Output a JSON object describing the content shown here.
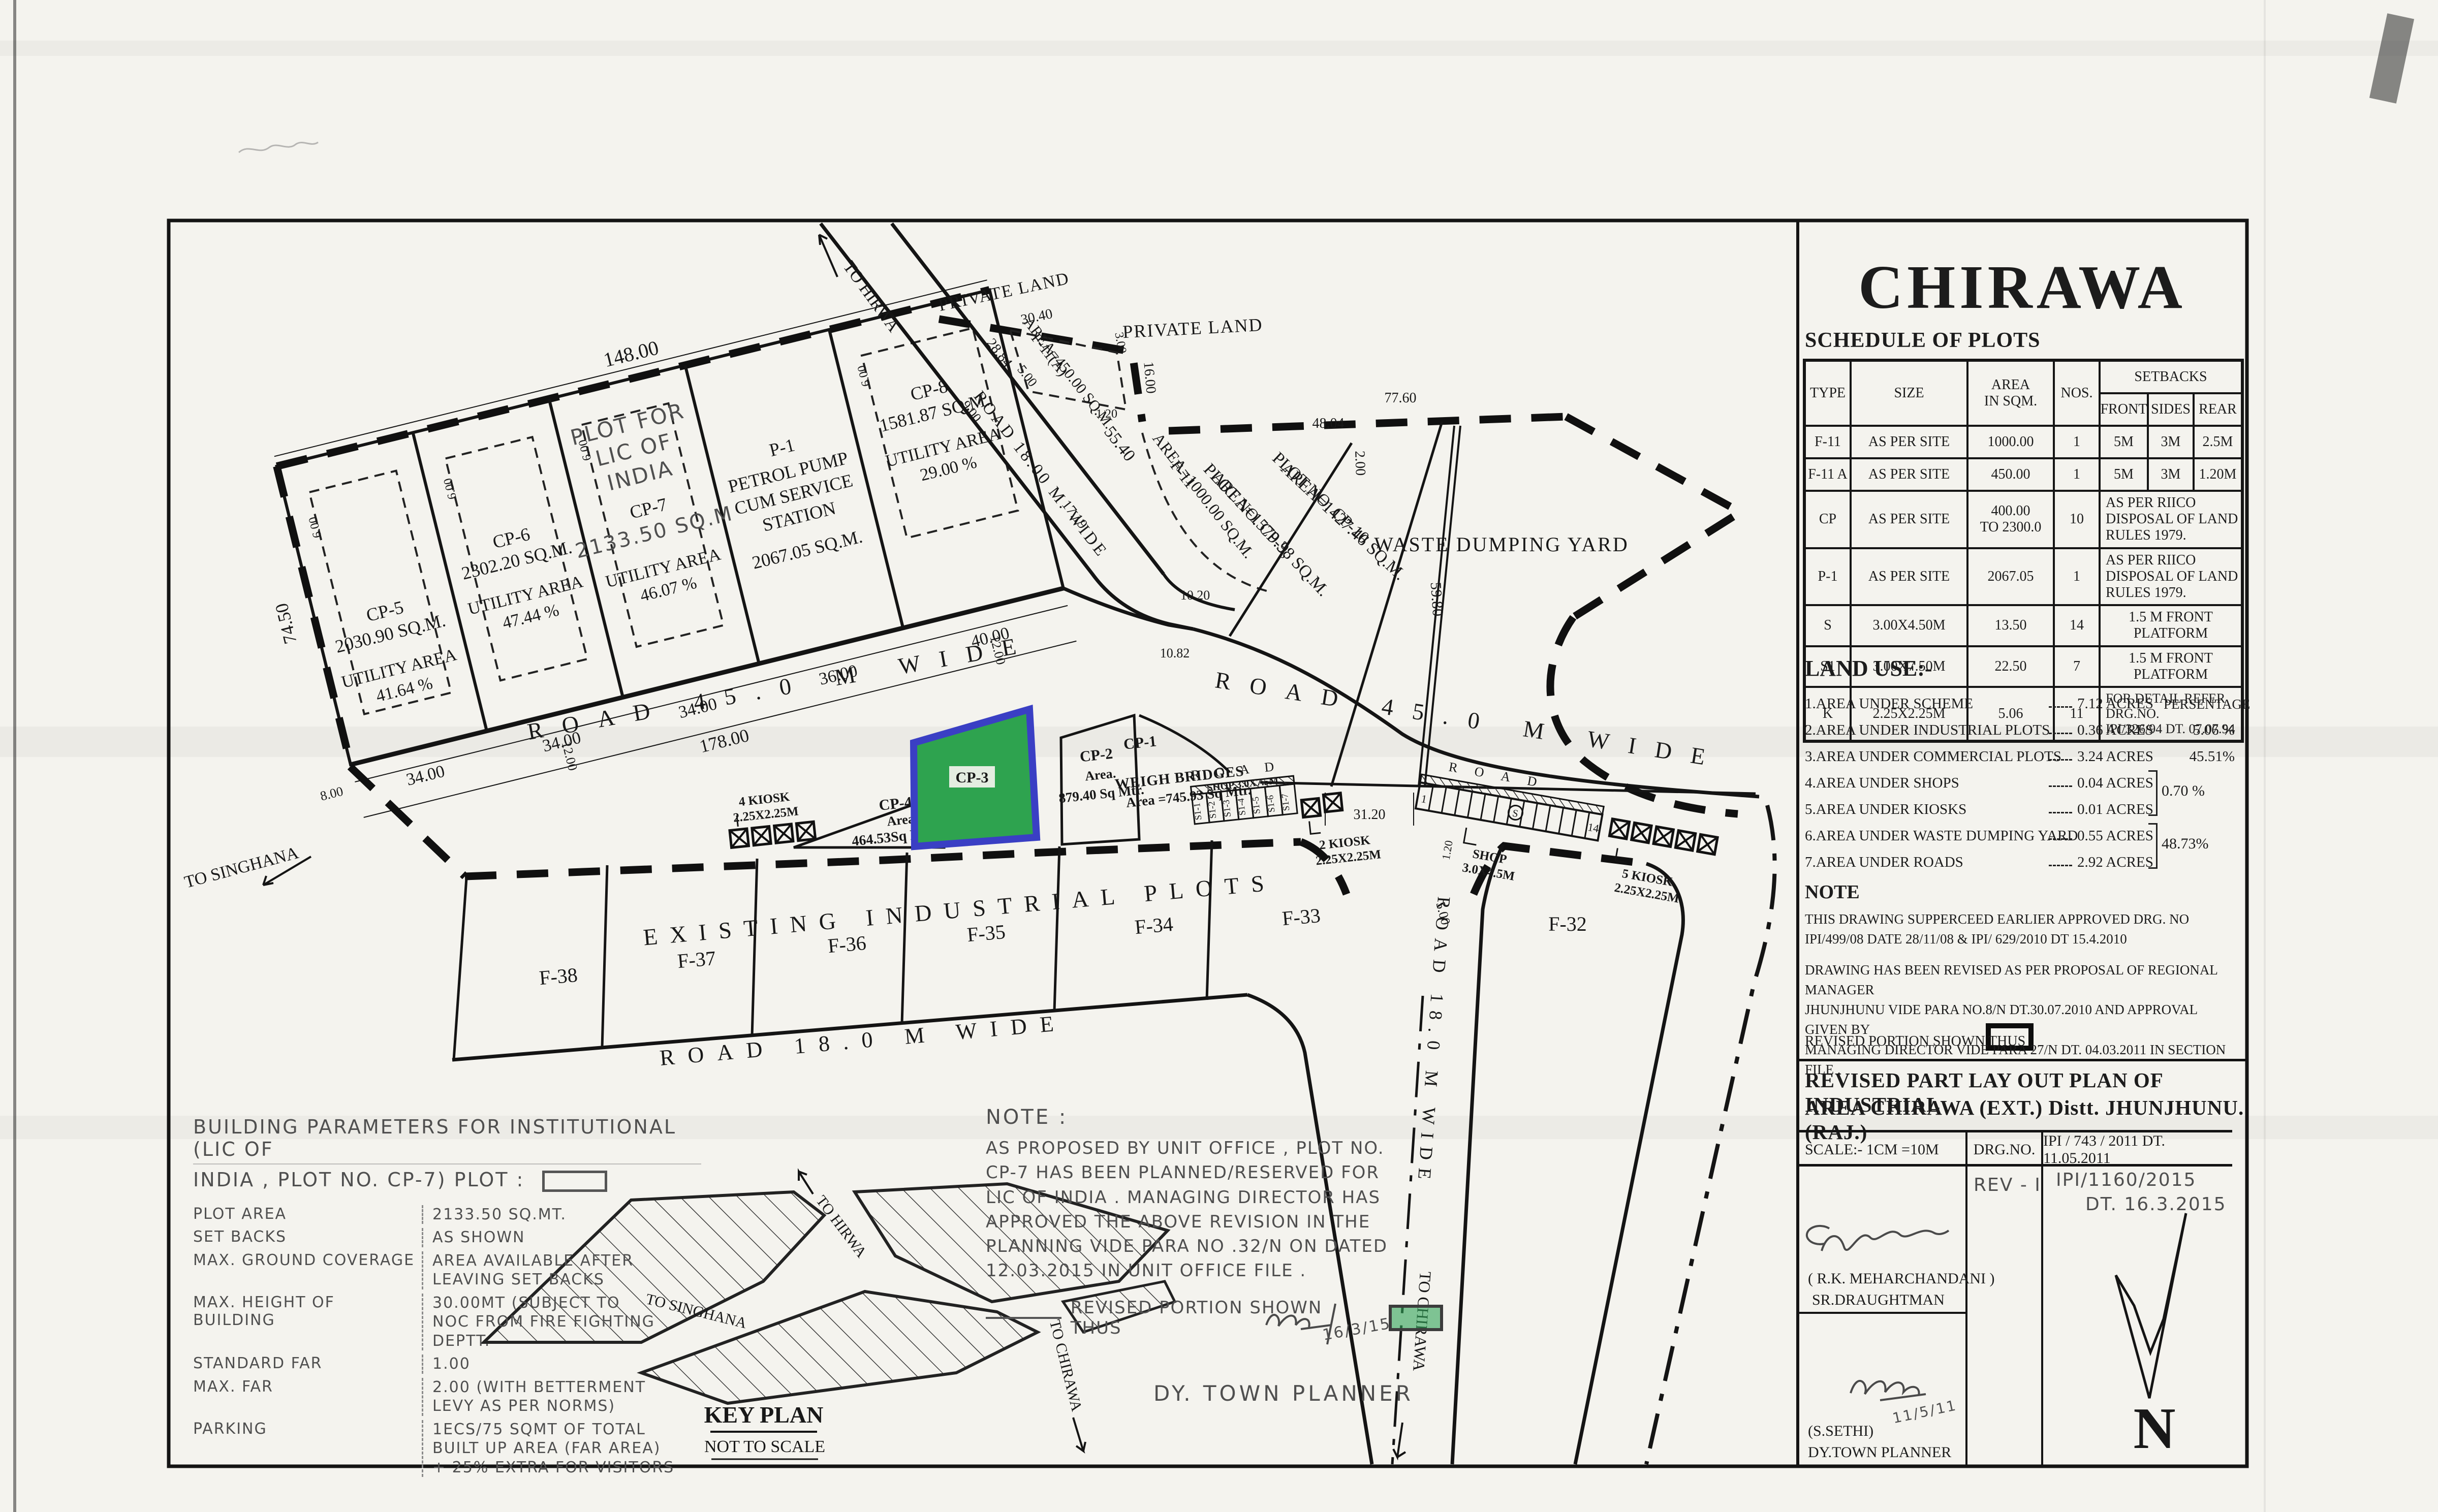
{
  "title_block": {
    "city": "CHIRAWA",
    "schedule": {
      "heading": "SCHEDULE OF PLOTS",
      "columns": {
        "type": "TYPE",
        "size": "SIZE",
        "area": "AREA\nIN SQM.",
        "nos": "NOS.",
        "setbacks": "SETBACKS",
        "front": "FRONT",
        "sides": "SIDES",
        "rear": "REAR"
      },
      "rows": [
        {
          "type": "F-11",
          "size": "AS PER SITE",
          "area": "1000.00",
          "nos": "1",
          "front": "5M",
          "sides": "3M",
          "rear": "2.5M"
        },
        {
          "type": "F-11 A",
          "size": "AS PER SITE",
          "area": "450.00",
          "nos": "1",
          "front": "5M",
          "sides": "3M",
          "rear": "1.20M"
        },
        {
          "type": "CP",
          "size": "AS PER SITE",
          "area": "400.00\nTO 2300.0",
          "nos": "10",
          "note": "AS PER RIICO DISPOSAL OF LAND RULES 1979."
        },
        {
          "type": "P-1",
          "size": "AS PER SITE",
          "area": "2067.05",
          "nos": "1",
          "note": "AS PER RIICO DISPOSAL OF LAND RULES 1979."
        },
        {
          "type": "S",
          "size": "3.00X4.50M",
          "area": "13.50",
          "nos": "14",
          "note": "1.5 M FRONT PLATFORM"
        },
        {
          "type": "S1",
          "size": "3.00X7.50M",
          "area": "22.50",
          "nos": "7",
          "note": "1.5 M FRONT PLATFORM"
        },
        {
          "type": "K",
          "size": "2.25X2.25M",
          "area": "5.06",
          "nos": "11",
          "note": "FOR DETAIL REFER DRG.NO.\nIPI/326/94 DT. 07.07.94"
        }
      ]
    },
    "land_use": {
      "heading": "LAND USE:-",
      "persentage": "PERSENTAGE",
      "items": [
        {
          "label": "1.AREA UNDER SCHEME",
          "value": "7.12  ACRES"
        },
        {
          "label": "2.AREA UNDER INDUSTRIAL PLOTS",
          "value": "0.36 ACRES",
          "pct": "5.06 %"
        },
        {
          "label": "3.AREA UNDER COMMERCIAL PLOTS",
          "value": "3.24 ACRES",
          "pct": "45.51%"
        },
        {
          "label": "4.AREA UNDER SHOPS",
          "value": "0.04 ACRES"
        },
        {
          "label": "5.AREA UNDER KIOSKS",
          "value": "0.01 ACRES"
        },
        {
          "label": "6.AREA UNDER WASTE DUMPING YARD",
          "value": "0.55 ACRES"
        },
        {
          "label": "7.AREA UNDER ROADS",
          "value": "2.92 ACRES"
        }
      ],
      "pct_shops_kiosks": "0.70 %",
      "pct_waste_roads": "48.73%"
    },
    "note": {
      "heading": "NOTE",
      "p1": "THIS DRAWING SUPPERCEED  EARLIER APPROVED DRG. NO\nIPI/499/08 DATE 28/11/08 & IPI/ 629/2010 DT 15.4.2010",
      "p2": "DRAWING HAS BEEN REVISED AS PER PROPOSAL OF  REGIONAL MANAGER\nJHUNJHUNU VIDE PARA NO.8/N DT.30.07.2010 AND APPROVAL GIVEN  BY\nMANAGING DIRECTOR VIDE PARA 27/N  DT. 04.03.2011 IN SECTION FILE .",
      "p3": "REVISED PORTION SHOWN THUS"
    },
    "plan_title_1": "REVISED PART LAY OUT  PLAN OF INDUSTRIAL",
    "plan_title_2": "AREA CHIRAWA (EXT.) Distt. JHUNJHUNU.(RAJ.)",
    "scale_row": {
      "scale": "SCALE:- 1CM =10M",
      "drg_label": "DRG.NO.",
      "drg_no": "IPI / 743 / 2011 DT. 11.05.2011"
    },
    "rev_row": {
      "rev": "REV - I",
      "no": "IPI/1160/2015",
      "dt": "DT. 16.3.2015"
    },
    "signs": {
      "sig2_date": "11/5/11",
      "name1": "( R.K. MEHARCHANDANI )",
      "role1": "SR.DRAUGHTMAN",
      "name2": "(S.SETHI)",
      "role2": "DY.TOWN PLANNER",
      "north": "N"
    }
  },
  "plan": {
    "roads": {
      "r45_left": "ROAD 45.0 M WIDE",
      "r45_right": "ROAD 45.0 M WIDE",
      "r18_diag": "ROAD 18.00 M. WIDE",
      "r18_bottom": "ROAD 18.0 M WIDE",
      "r18_vert": "ROAD 18.0 M WIDE",
      "road_small_1": "ROAD",
      "road_small_2": "ROAD"
    },
    "dirs": {
      "to_hirwa": "TO HIRWA",
      "to_singhana": "TO SINGHANA",
      "to_chirawa": "TO CHIRAWA"
    },
    "private_land": "PRIVATE LAND",
    "waste_yard": "WASTE DUMPING YARD",
    "existing": "EXISTING INDUSTRIAL PLOTS",
    "plots": {
      "cp5": {
        "name": "CP-5",
        "area": "2030.90 SQ.M.",
        "util": "UTILITY AREA",
        "pct": "41.64 %"
      },
      "cp6": {
        "name": "CP-6",
        "area": "2302.20 SQ.M.",
        "util": "UTILITY AREA",
        "pct": "47.44 %"
      },
      "cp7": {
        "name": "CP-7",
        "area": "2133.50 SQ.M",
        "util": "UTILITY AREA",
        "pct": "46.07 %",
        "hand1": "PLOT FOR",
        "hand2": "LIC OF",
        "hand3": "INDIA"
      },
      "p1": {
        "name": "P-1",
        "l1": "PETROL PUMP",
        "l2": "CUM SERVICE",
        "l3": "STATION",
        "area": "2067.05 SQ.M."
      },
      "cp8": {
        "name": "CP-8",
        "area": "1581.87 SQ.M.",
        "util": "UTILITY AREA",
        "pct": "29.00 %"
      },
      "f11a": {
        "name": "F-11(A)",
        "area": "AREA=450.00 SQ.M."
      },
      "f11": {
        "name": "F-11",
        "area": "AREA=1000.00 SQ.M."
      },
      "cp9": {
        "name": "PLOT NO. CP-9,",
        "area": "AREA=1579.38 SQ.M."
      },
      "cp10": {
        "name": "PLOT NO. CP-10",
        "area": "AREA=1427.46 SQ.M."
      },
      "cp4": {
        "name": "CP-4",
        "l1": "Area",
        "area": "464.53Sq Mtr."
      },
      "cp3": {
        "name": "CP-3"
      },
      "cp2": {
        "name": "CP-2",
        "l1": "Area.",
        "area": "879.40 Sq Mtr."
      },
      "cp1": {
        "name": "CP-1",
        "l1": "WEIGH BRIDGES",
        "area": "Area =745.93 Sq Mtr."
      },
      "f_row": [
        "F-38",
        "F-37",
        "F-36",
        "F-35",
        "F-34",
        "F-33"
      ],
      "f32": "F-32"
    },
    "shops": {
      "s1_labels": [
        "S1-1",
        "S1-2",
        "S1-3",
        "S1-4",
        "S1-5",
        "S1-6",
        "S1-7"
      ],
      "s1_title": "SHOP  3.0X7.5M",
      "s_first": "1",
      "s_mid": "S",
      "s_last": "14",
      "s_title1": "SHOP",
      "s_title2": "3.0X4.5M",
      "k4_1": "4 KIOSK",
      "k4_2": "2.25X2.25M",
      "k2_1": "2 KIOSK",
      "k2_2": "2.25X2.25M",
      "k5_1": "5 KIOSK",
      "k5_2": "2.25X2.25M"
    },
    "dims": {
      "d148": "148.00",
      "d7450": "74.50",
      "d34": "34.00",
      "d36": "36.00",
      "d40": "40.00",
      "d178": "178.00",
      "d12": "12.00",
      "d8": "8.00",
      "d6": "6.00",
      "d9": "9.00",
      "d2884": "28.84",
      "d5": "5.00",
      "d5540": "55.40",
      "d3040": "30.40",
      "d3": "3.00",
      "d16": "16.00",
      "d120": "1.20",
      "d7760": "77.60",
      "d4804": "48.04",
      "d2": "2.00",
      "d1719": "17.19",
      "d1020": "10.20",
      "d1082": "10.82",
      "d5980": "59.80",
      "d3120": "31.20"
    },
    "key_plan": {
      "title": "KEY PLAN",
      "sub": "NOT TO SCALE",
      "to_hirwa": "TO HIRWA",
      "to_singhana": "TO SINGHANA",
      "to_chirawa": "TO CHIRAWA"
    }
  },
  "bparams": {
    "h1": "BUILDING PARAMETERS FOR INSTITUTIONAL (LIC OF",
    "h2": "INDIA , PLOT NO. CP-7) PLOT :",
    "rows": [
      {
        "k": "PLOT AREA",
        "v": "2133.50 SQ.MT."
      },
      {
        "k": "SET BACKS",
        "v": "AS SHOWN"
      },
      {
        "k": "MAX. GROUND COVERAGE",
        "v": "AREA AVAILABLE AFTER\nLEAVING SET BACKS"
      },
      {
        "k": "MAX. HEIGHT OF BUILDING",
        "v": "30.00MT (SUBJECT TO\nNOC FROM FIRE FIGHTING\nDEPTT."
      },
      {
        "k": "STANDARD FAR",
        "v": "1.00"
      },
      {
        "k": "MAX. FAR",
        "v": "2.00 (WITH BETTERMENT\nLEVY AS PER NORMS)"
      },
      {
        "k": "PARKING",
        "v": "1ECS/75 SQMT OF TOTAL\nBUILT UP AREA (FAR AREA)\n+ 25% EXTRA FOR VISITORS"
      }
    ]
  },
  "cnote": {
    "heading": "NOTE :",
    "body": "AS PROPOSED BY UNIT OFFICE , PLOT NO.\nCP-7 HAS BEEN PLANNED/RESERVED FOR\nLIC OF INDIA . MANAGING DIRECTOR HAS\nAPPROVED THE ABOVE REVISION IN THE\nPLANNING VIDE PARA NO .32/N ON DATED\n12.03.2015 IN UNIT OFFICE FILE .",
    "revised": "REVISED PORTION SHOWN THUS",
    "sig_date": "16/3/15",
    "signoff": "DY. TOWN PLANNER"
  }
}
